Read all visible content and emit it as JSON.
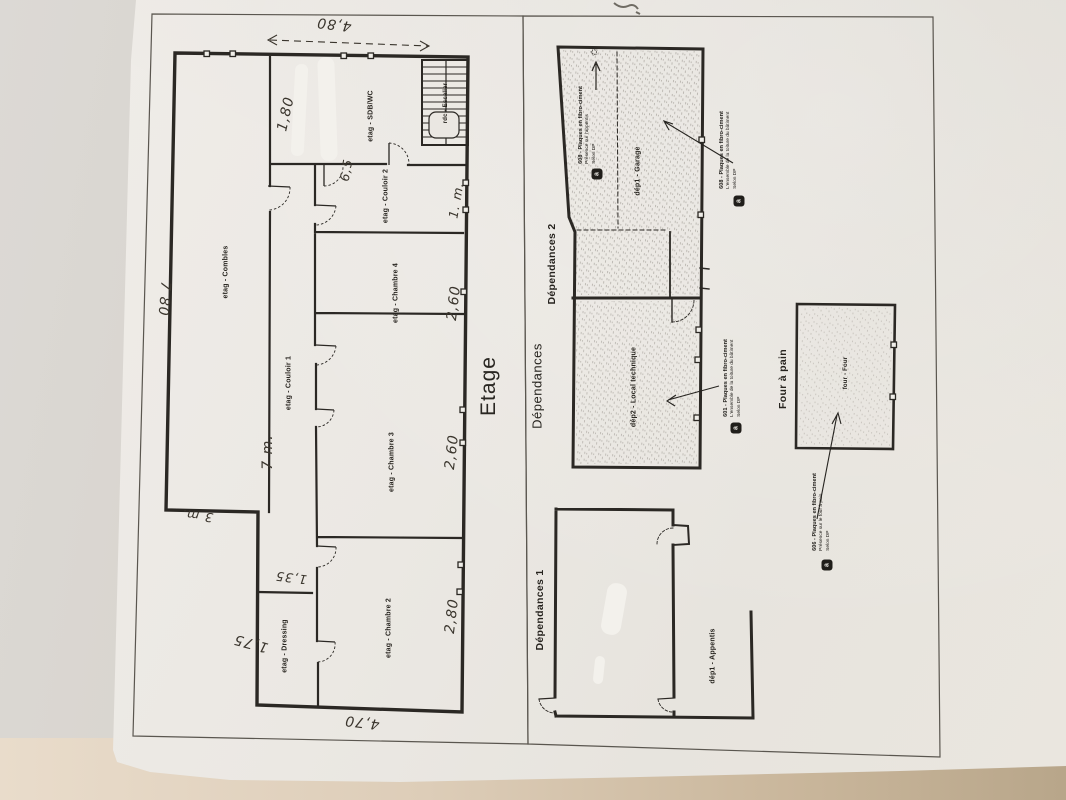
{
  "colors": {
    "ink": "#2b2824",
    "page_frame": "#5a564f",
    "paper": "#eae7e2",
    "desk": "#d2c9bb",
    "desk_edge": "#c3b198",
    "handwriting": "#3a352d"
  },
  "etage": {
    "title": "Etage",
    "rooms": {
      "combles": "etag - Combles",
      "sdb_wc": "etag - SDB/WC",
      "couloir2": "etag - Couloir 2",
      "chambre4": "etag - Chambre 4",
      "couloir1": "etag - Couloir 1",
      "chambre3": "etag - Chambre 3",
      "chambre2": "etag - Chambre 2",
      "dressing": "etag - Dressing",
      "escalier": "rdc - Escalier"
    },
    "dims": [
      "4,80",
      "1,80",
      "6,5",
      "1. m.",
      "7 80",
      "7 m.",
      "3 m.",
      "1,35",
      "1,75",
      "2,80",
      "2,60",
      "2,60",
      "4,70"
    ]
  },
  "dependances": {
    "title": "Dépendances",
    "plan2_title": "Dépendances 2",
    "plan1_title": "Dépendances 1",
    "rooms": {
      "garage": "dép1 - Garage",
      "local_technique": "dép2 - Local technique",
      "appentis": "dép1 - Appentis",
      "four": "four - Four"
    },
    "four_title": "Four à pain",
    "annotations": [
      {
        "title": "608 - Plaques en fibro-ciment",
        "line2": "Présence sur l'appentis",
        "line3": "Selon DP"
      },
      {
        "title": "608 - Plaques en fibro-ciment",
        "line2": "L'ensemble de la toiture du bâtiment",
        "line3": "Selon DP"
      },
      {
        "title": "601 - Plaques en fibro-ciment",
        "line2": "L'ensemble de la toiture du bâtiment",
        "line3": "Selon DP"
      },
      {
        "title": "606 - Plaques en fibro-ciment",
        "line2": "Présence sur le four à pain",
        "line3": "Selon DP"
      }
    ],
    "icons": {
      "asbestos_badge": "a",
      "north_star": "✩"
    }
  }
}
